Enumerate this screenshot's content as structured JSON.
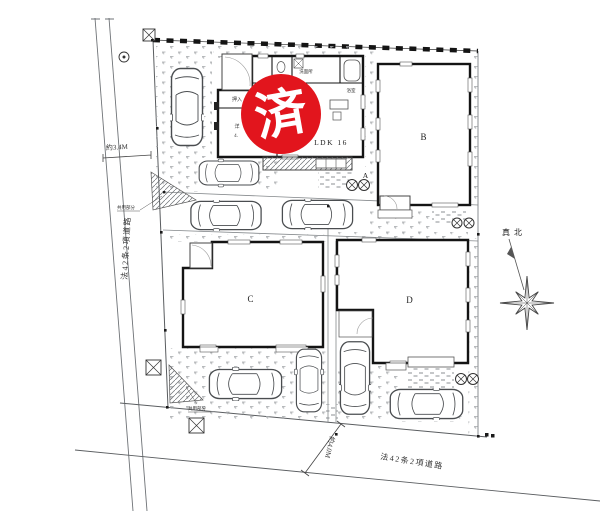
{
  "stamp": {
    "label": "済",
    "color": "#e2151d"
  },
  "buildings": {
    "a": "A",
    "b": "B",
    "c": "C",
    "d": "D"
  },
  "rooms": {
    "closet": "押入",
    "western1": "洋",
    "western2": "4.",
    "washroom": "洗面所",
    "bath": "浴室",
    "ldk": "LDK 16"
  },
  "dimensions": {
    "left": "約3.4M",
    "bottom": "約4.0M"
  },
  "roads": {
    "left": "法42条2項道路",
    "bottom": "法42条2項道路"
  },
  "compass": {
    "north": "真北"
  },
  "annotations": {
    "common_area_left": "共用部分",
    "common_area_bottom": "共用部分"
  },
  "colors": {
    "wall": "#1a1a1a",
    "line": "#555555",
    "stamp": "#e2151d"
  }
}
